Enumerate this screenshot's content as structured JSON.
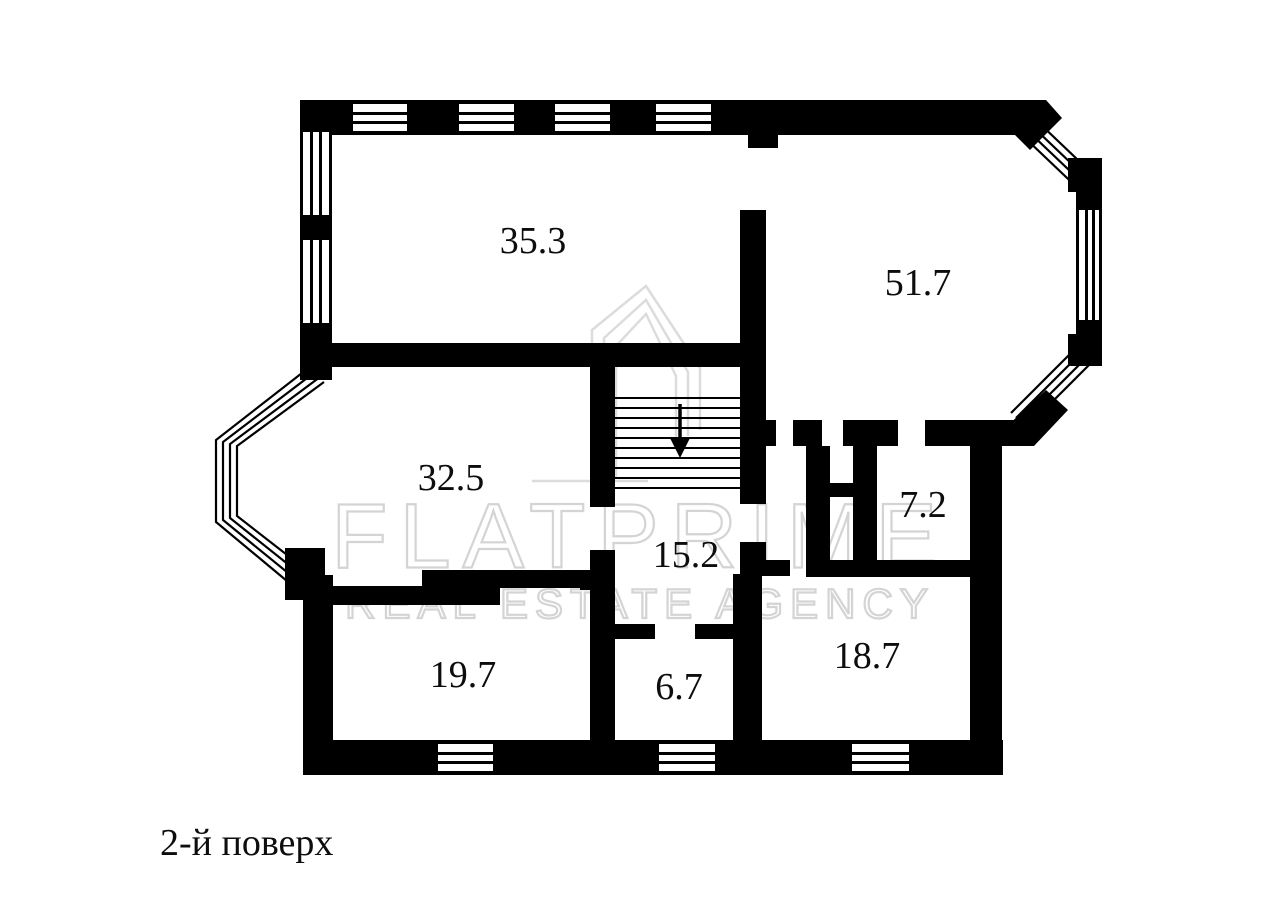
{
  "floorplan": {
    "caption": "2-й поверх",
    "watermark": {
      "brand": "FLATPRIME",
      "subtitle": "REAL ESTATE AGENCY"
    },
    "stairs": {
      "arrow_direction": "down"
    },
    "rooms": [
      {
        "area": "35.3"
      },
      {
        "area": "51.7"
      },
      {
        "area": "32.5"
      },
      {
        "area": "15.2"
      },
      {
        "area": "7.2"
      },
      {
        "area": "19.7"
      },
      {
        "area": "6.7"
      },
      {
        "area": "18.7"
      }
    ],
    "colors": {
      "wall": "#000000",
      "background": "#ffffff",
      "watermark": "#d4d4d4",
      "text": "#0d0d0d"
    }
  }
}
